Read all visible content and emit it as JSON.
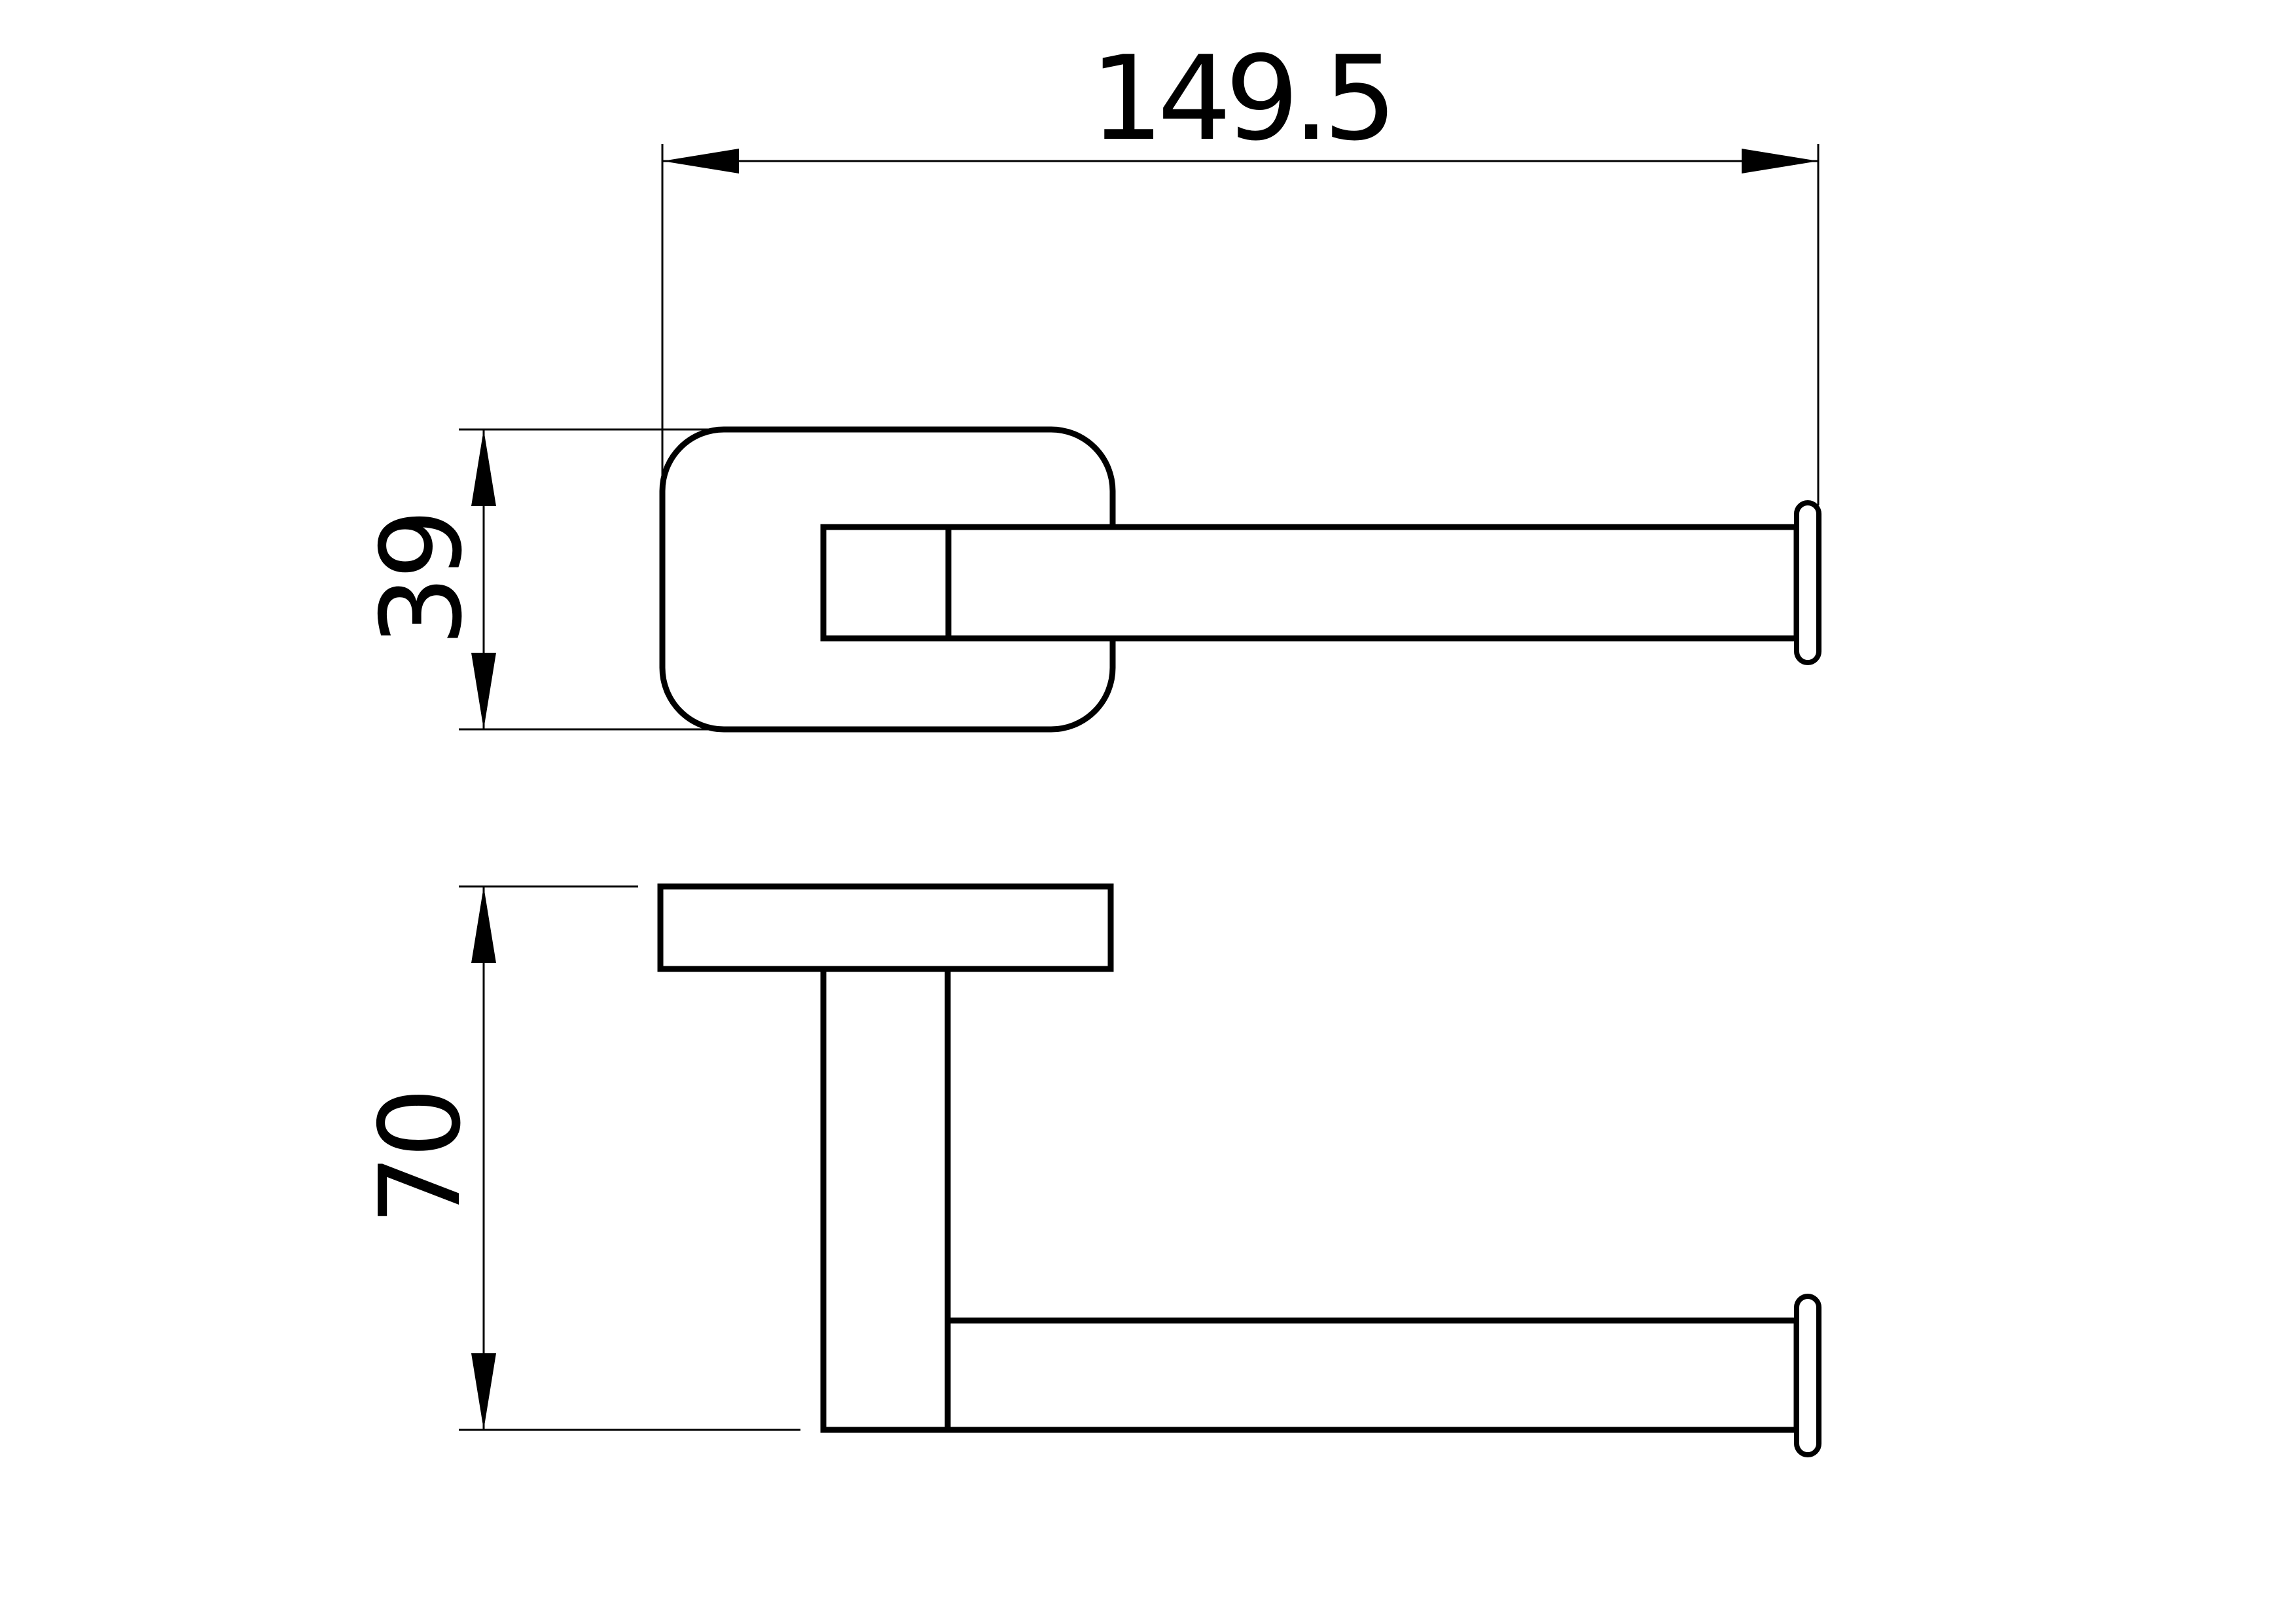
{
  "drawing": {
    "dimensions": {
      "overall_width_mm": "149.5",
      "plate_height_mm": "39",
      "overall_height_mm": "70"
    },
    "colors": {
      "line": "#000000",
      "background": "#ffffff"
    }
  }
}
